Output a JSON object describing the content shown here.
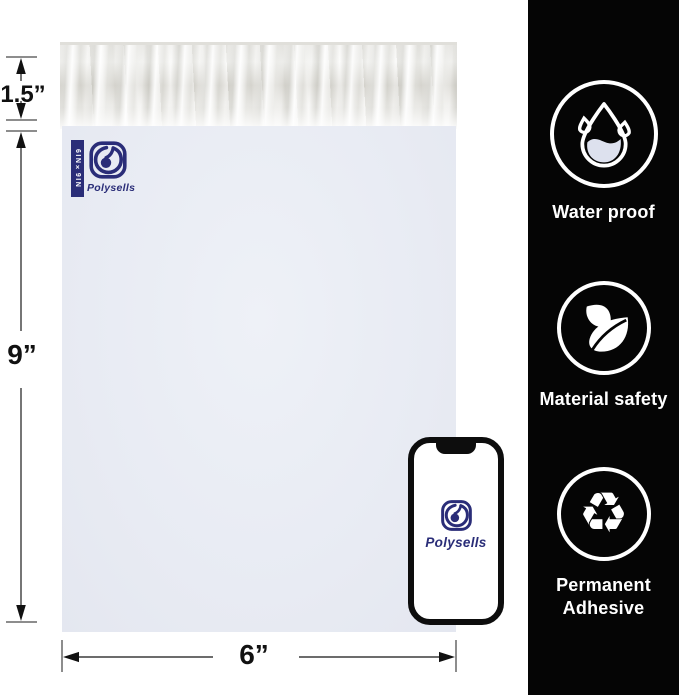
{
  "annotations": {
    "flap_height": "1.5”",
    "bag_height": "9”",
    "bag_width": "6”"
  },
  "mailer": {
    "brand": "Polysells",
    "size_badge": "6IN×9IN"
  },
  "phone": {
    "brand": "Polysells"
  },
  "sidebar": {
    "features": [
      {
        "name": "water-proof",
        "label": "Water proof"
      },
      {
        "name": "material-safety",
        "label": "Material safety"
      },
      {
        "name": "permanent-adhesive",
        "label": "Permanent Adhesive"
      }
    ],
    "recycle_glyph": "♻"
  },
  "colors": {
    "brand_navy": "#2a2d78",
    "sidebar_bg": "#050505",
    "mailer_body": "#e8ebf3"
  }
}
